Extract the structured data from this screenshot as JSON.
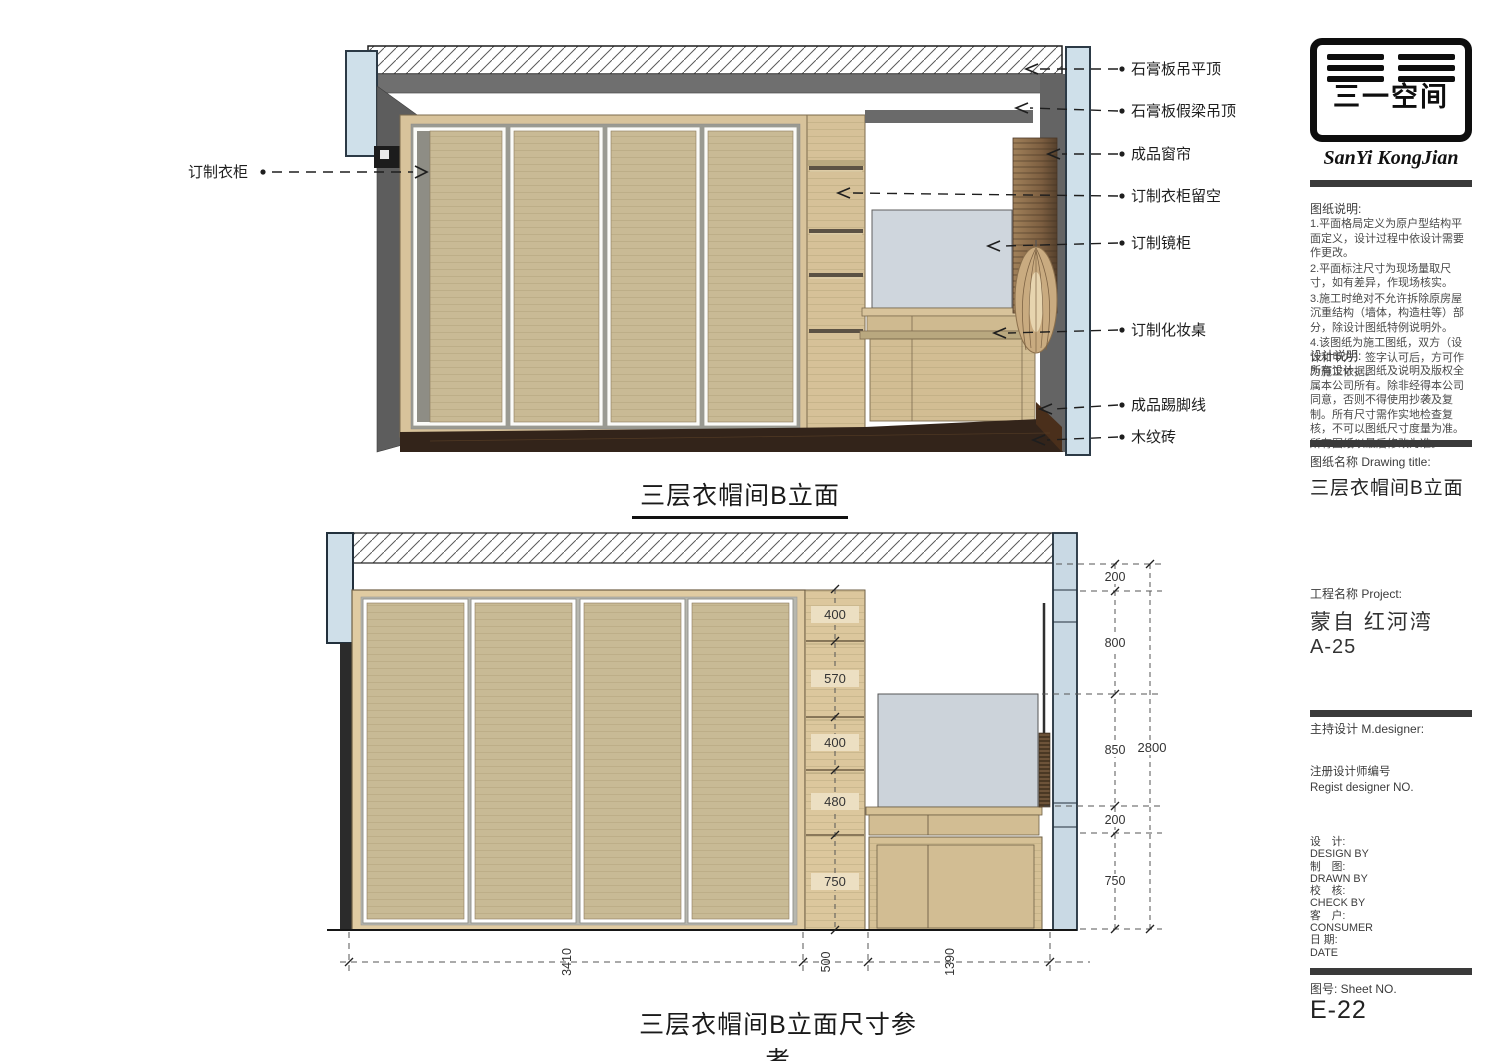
{
  "colors": {
    "wood_tan": "#c9ba95",
    "wood_frame": "#dcc79d",
    "wall_gray": "#646464",
    "glass_blue": "#cfe0ea",
    "floor_brown": "#33241a",
    "mirror_gray": "#ccd3da",
    "curtain_brown": "#7a5c3c"
  },
  "top_view": {
    "title": "三层衣帽间B立面",
    "left_label": "订制衣柜",
    "right_labels": [
      "石膏板吊平顶",
      "石膏板假梁吊顶",
      "成品窗帘",
      "订制衣柜留空",
      "订制镜柜",
      "订制化妆桌",
      "成品踢脚线",
      "木纹砖"
    ]
  },
  "bottom_view": {
    "title": "三层衣帽间B立面尺寸参考",
    "column_dims": [
      "400",
      "570",
      "400",
      "480",
      "750"
    ],
    "right_dims": [
      "200",
      "800",
      "850",
      "200",
      "750"
    ],
    "total_height": "2800",
    "bottom_dims": [
      "3410",
      "500",
      "1390"
    ]
  },
  "sidebar": {
    "logo_stamp": "三一空间",
    "logo_script": "SanYi KongJian",
    "notes": {
      "heading": "图纸说明:",
      "items": [
        "1.平面格局定义为原户型结构平面定义，设计过程中依设计需要作更改。",
        "2.平面标注尺寸为现场量取尺寸，如有差异，作现场核实。",
        "3.施工时绝对不允许拆除原房屋沉重结构（墙体，构造柱等）部分，除设计图纸特例说明外。",
        "4.该图纸为施工图纸，双方（设计和甲方）签字认可后，方可作为施工依据。"
      ]
    },
    "design_notes": {
      "heading": "设计说明:",
      "body": "所有设计、图纸及说明及版权全属本公司所有。除非经得本公司同意，否则不得使用抄袭及复制。所有尺寸需作实地检查复核，不可以图纸尺寸度量为准。所有图纸以最后修改为准。"
    },
    "drawing_title": {
      "label": "图纸名称  Drawing title:",
      "value": "三层衣帽间B立面"
    },
    "project": {
      "label": "工程名称  Project:",
      "name": "蒙自 红河湾",
      "unit": "A-25"
    },
    "m_designer": {
      "label": "主持设计  M.designer:"
    },
    "regist": {
      "line1": "注册设计师编号",
      "line2": "Regist designer NO."
    },
    "credits": [
      {
        "cn": "设　计:",
        "en": "DESIGN BY"
      },
      {
        "cn": "制　图:",
        "en": "DRAWN BY"
      },
      {
        "cn": "校　核:",
        "en": "CHECK BY"
      },
      {
        "cn": "客　户:",
        "en": "CONSUMER"
      },
      {
        "cn": "日 期:",
        "en": "DATE"
      }
    ],
    "sheet": {
      "label": "图号:  Sheet NO.",
      "value": "E-22"
    }
  }
}
